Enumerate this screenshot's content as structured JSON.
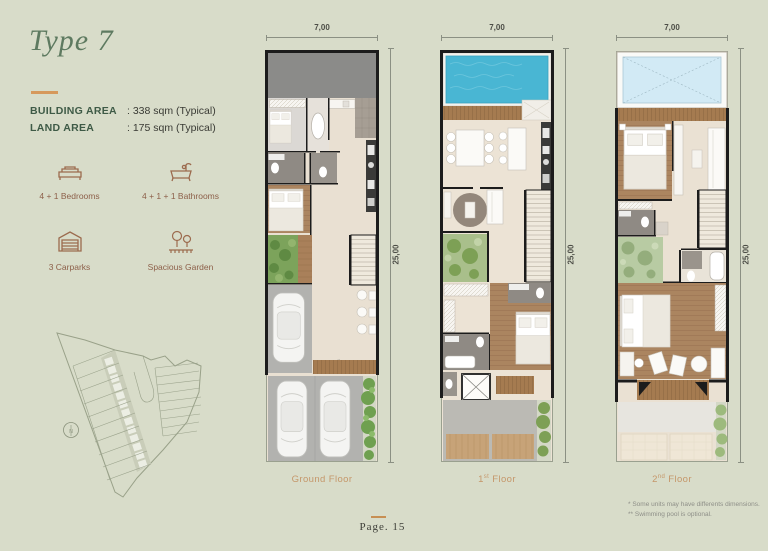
{
  "header": {
    "title": "Type 7"
  },
  "specs": {
    "building_area": {
      "label": "BUILDING AREA",
      "value": ": 338 sqm (Typical)"
    },
    "land_area": {
      "label": "LAND AREA",
      "value": ": 175 sqm (Typical)"
    }
  },
  "features": [
    {
      "icon": "bed-icon",
      "label": "4 + 1 Bedrooms"
    },
    {
      "icon": "bathtub-icon",
      "label": "4 + 1 + 1 Bathrooms"
    },
    {
      "icon": "carport-icon",
      "label": "3 Carparks"
    },
    {
      "icon": "garden-icon",
      "label": "Spacious Garden"
    }
  ],
  "site_plan": {
    "compass_label": "N"
  },
  "plans": [
    {
      "id": "ground-floor",
      "width_dim": "7,00",
      "height_dim": "25,00",
      "label": {
        "pre": "Ground Floor",
        "sup": "",
        "post": ""
      }
    },
    {
      "id": "first-floor",
      "width_dim": "7,00",
      "height_dim": "25,00",
      "label": {
        "pre": "1",
        "sup": "st",
        "post": " Floor"
      }
    },
    {
      "id": "second-floor",
      "width_dim": "7,00",
      "height_dim": "25,00",
      "label": {
        "pre": "2",
        "sup": "nd",
        "post": " Floor"
      }
    }
  ],
  "footnotes": [
    "* Some units may have differents dimensions.",
    "** Swimming pool is optional."
  ],
  "footer": {
    "page_label": "Page. 15"
  },
  "colors": {
    "background": "#d8dcc9",
    "accent": "#d6995c",
    "title_green": "#5e7a60",
    "label_green": "#3e5a46",
    "floor_label": "#c5976a",
    "pool_blue": "#49b6d3"
  }
}
